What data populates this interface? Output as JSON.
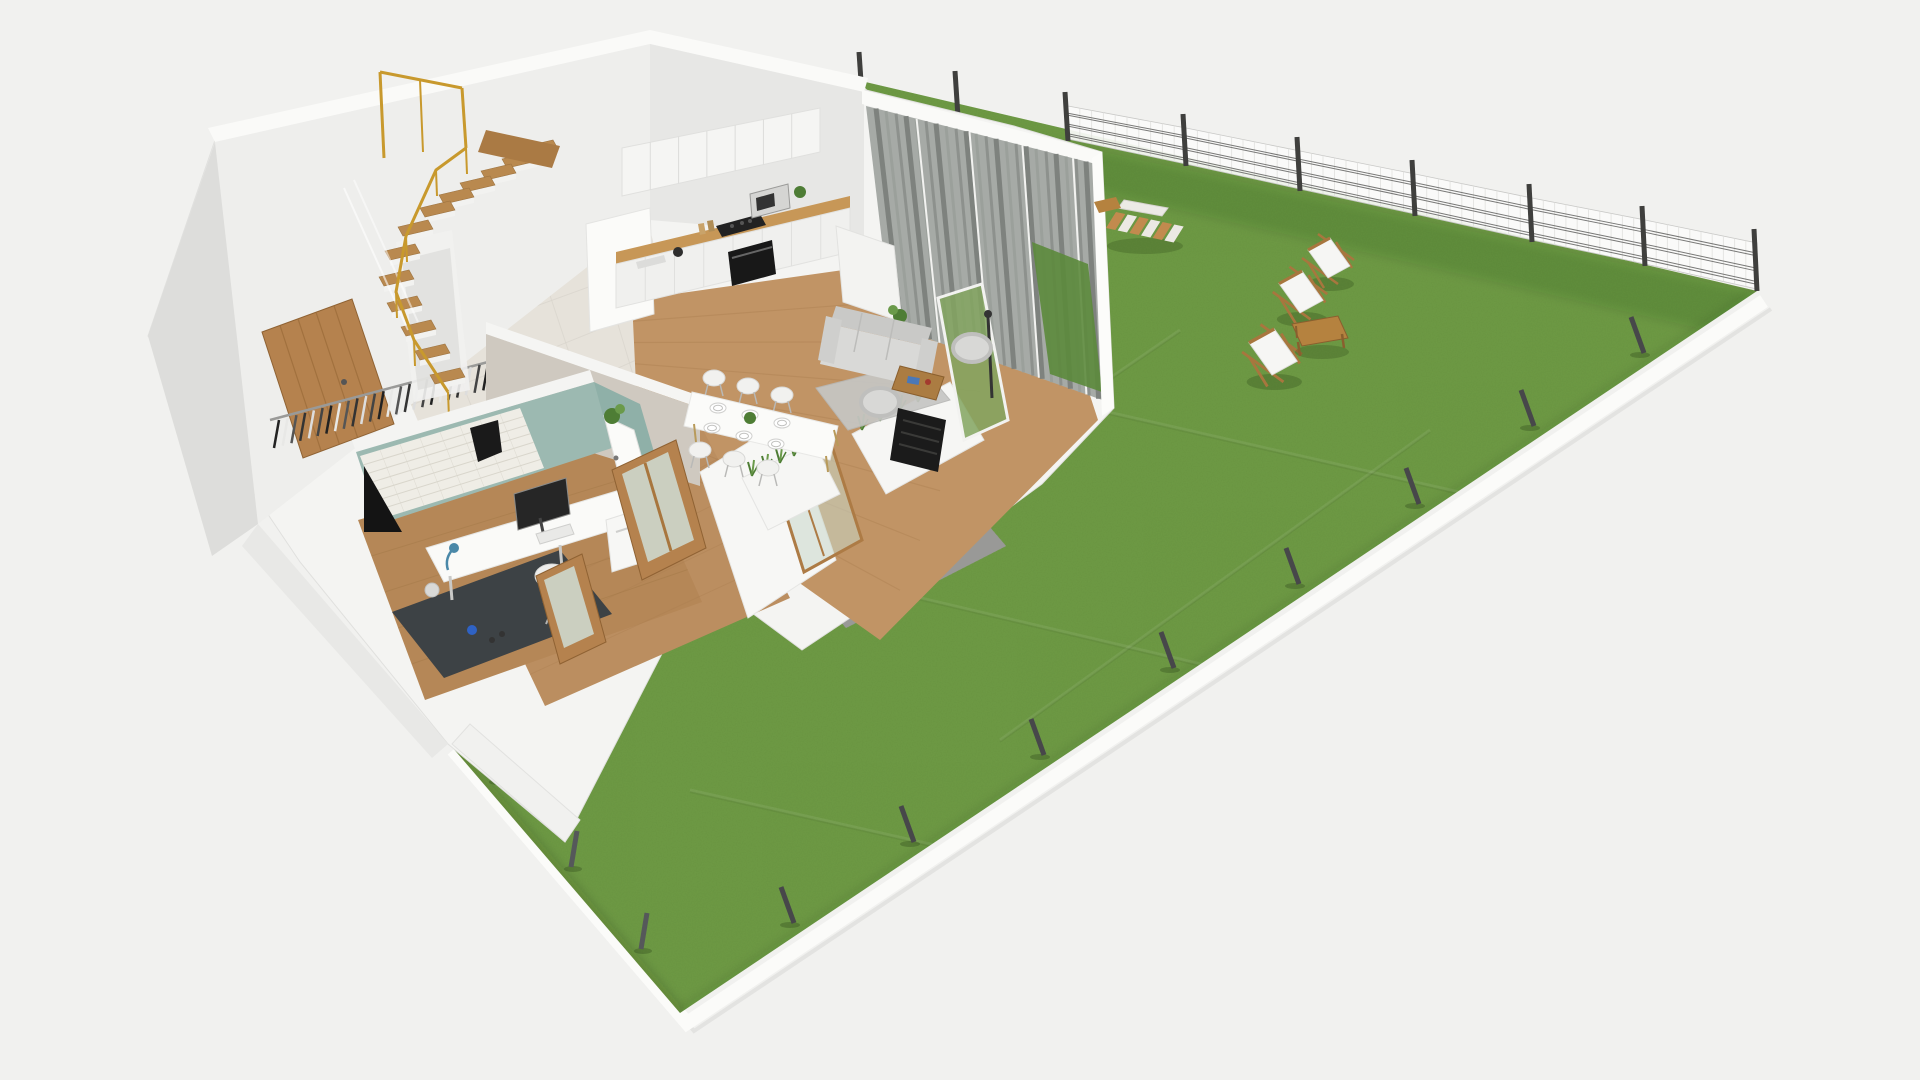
{
  "meta": {
    "description": "3D axonometric cutaway render of a single-storey apartment floor plan with a large fenced garden lawn",
    "rooms_visible": [
      "entry-hall-with-staircase",
      "home-office",
      "kitchen",
      "living-dining-room",
      "hallway"
    ],
    "garden_objects": [
      "lawn",
      "mesh-fence",
      "fence-posts",
      "deck-chairs",
      "garden-coffee-table",
      "slatted-bench",
      "gravel-border"
    ]
  },
  "colors": {
    "background": "#f1f1ef",
    "grass": "#6f9b45",
    "grass_shade": "rgba(30,50,15,0.13)",
    "curb": "#fbfbf9",
    "fence_post": "#3f3f3d",
    "fence_panel": "rgba(251,251,250,0.92)",
    "fence_rail": "#6b6b69",
    "platform": "#f4f4f2",
    "wall_top": "#fafaf8",
    "wall_face": "#eeeeec",
    "wall_shade": "#dddddb",
    "gravel": "#a3a3a1",
    "tile_floor": "#e6e2da",
    "wood_floor": "#c19465",
    "wood_door": "#b5824e",
    "counter_wood": "#c79757",
    "cabinet_white": "#f5f5f3",
    "teal_wall": "#9cb9b1",
    "teal_wall2": "#8fb0a8",
    "brick_wall": "#efede6",
    "gold_rail": "#c8992d",
    "stair_wood": "#b9894f",
    "curtain": "#a6aaa6",
    "hedge": "#5c8a3c",
    "sofa": "#d9d9d7",
    "dark_unit": "#1b1b1b",
    "plant_green": "#4e7d35",
    "accent_blue": "#2f62c4"
  },
  "counts": {
    "deck_chairs": 3,
    "fence_panels": 6,
    "top_fence_posts": 9,
    "right_edge_posts": 8,
    "south_edge_posts": 3,
    "stair_steps": 13,
    "dining_chairs": 6,
    "dining_plates": 6,
    "coat_hangers": 26
  },
  "scene": {
    "lawn": {
      "grass_points": "857,80 1757,291 680,1013 446,740 590,590 760,462 900,362 958,252 900,122",
      "curb_path": "M1757,291 L680,1013 L446,740",
      "seams": [
        [
          880,
          360,
          1560,
          515
        ],
        [
          760,
          560,
          1290,
          685
        ],
        [
          690,
          790,
          1010,
          862
        ],
        [
          1180,
          330,
          830,
          570
        ],
        [
          1430,
          430,
          1000,
          740
        ]
      ]
    },
    "fence_top": {
      "posts": [
        {
          "x": 862,
          "y": 96,
          "h": 36
        },
        {
          "x": 958,
          "y": 117,
          "h": 38
        },
        {
          "x": 1068,
          "y": 141,
          "h": 41
        },
        {
          "x": 1186,
          "y": 166,
          "h": 44
        },
        {
          "x": 1300,
          "y": 191,
          "h": 46
        },
        {
          "x": 1415,
          "y": 216,
          "h": 48
        },
        {
          "x": 1532,
          "y": 242,
          "h": 50
        },
        {
          "x": 1645,
          "y": 266,
          "h": 52
        },
        {
          "x": 1757,
          "y": 291,
          "h": 54
        }
      ],
      "panel_from": 2
    },
    "right_posts": [
      [
        1644,
        353
      ],
      [
        1534,
        426
      ],
      [
        1419,
        504
      ],
      [
        1299,
        584
      ],
      [
        1174,
        668
      ],
      [
        1044,
        755
      ],
      [
        914,
        842
      ],
      [
        794,
        923
      ]
    ],
    "south_posts": [
      [
        496,
        780
      ],
      [
        571,
        867
      ],
      [
        641,
        949
      ]
    ],
    "deck_chairs": [
      {
        "x": 1328,
        "y": 258,
        "s": 1.0
      },
      {
        "x": 1300,
        "y": 292,
        "s": 1.05
      },
      {
        "x": 1272,
        "y": 352,
        "s": 1.15
      }
    ],
    "garden_table": {
      "x": 1318,
      "y": 332
    },
    "bench": {
      "ax": 1116,
      "ay": 212,
      "bx": 1186,
      "by": 227
    },
    "house": {
      "stairs": [
        [
          540,
          152
        ],
        [
          519,
          164
        ],
        [
          498,
          176
        ],
        [
          477,
          188
        ],
        [
          456,
          200
        ],
        [
          437,
          213
        ],
        [
          415,
          232
        ],
        [
          402,
          256
        ],
        [
          396,
          282
        ],
        [
          404,
          308
        ],
        [
          418,
          332
        ],
        [
          432,
          356
        ],
        [
          447,
          380
        ]
      ],
      "gold_rail": [
        [
          466,
          148
        ],
        [
          436,
          170
        ],
        [
          406,
          236
        ],
        [
          396,
          292
        ],
        [
          414,
          340
        ],
        [
          448,
          392
        ]
      ],
      "hangers": {
        "a": [
          274,
          448
        ],
        "b": [
          492,
          388
        ],
        "n": 26
      },
      "curtains": {
        "quad": [
          [
            866,
            106
          ],
          [
            1096,
            164
          ],
          [
            1108,
            402
          ],
          [
            892,
            326
          ]
        ],
        "n": 22
      },
      "door_quad": [
        [
          262,
          332
        ],
        [
          352,
          299
        ],
        [
          394,
          424
        ],
        [
          303,
          458
        ]
      ],
      "dining": {
        "plates": [
          [
            718,
            408
          ],
          [
            750,
            415
          ],
          [
            782,
            423
          ],
          [
            712,
            428
          ],
          [
            744,
            436
          ],
          [
            776,
            444
          ]
        ],
        "chairs": [
          [
            714,
            378
          ],
          [
            748,
            386
          ],
          [
            782,
            395
          ],
          [
            700,
            450
          ],
          [
            734,
            459
          ],
          [
            768,
            468
          ]
        ],
        "plant": [
          750,
          418
        ]
      },
      "planter_tufts": [
        [
          752,
          476
        ],
        [
          766,
          470
        ],
        [
          780,
          463
        ],
        [
          794,
          456
        ],
        [
          862,
          430
        ],
        [
          880,
          421
        ],
        [
          900,
          411
        ],
        [
          918,
          402
        ],
        [
          936,
          392
        ]
      ]
    }
  }
}
